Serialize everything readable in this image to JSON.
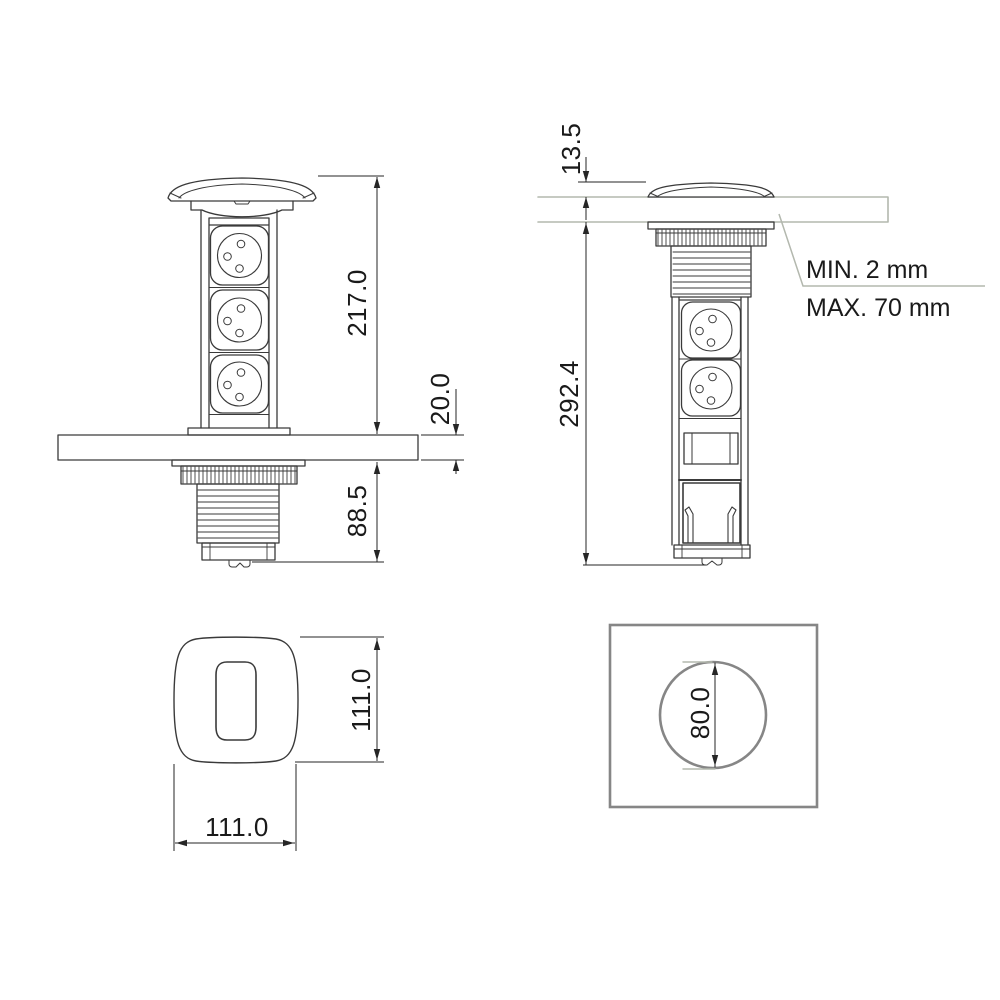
{
  "colors": {
    "background": "#ffffff",
    "line": "#3a3a3a",
    "dimension": "#262626",
    "light_line": "#b3b8ae",
    "cutout_gray": "#868686"
  },
  "front_view": {
    "pop_up_height": "217.0",
    "counter_thickness": "20.0",
    "under_counter_depth": "88.5"
  },
  "side_view": {
    "lid_height": "13.5",
    "overall_height": "292.4",
    "note_min": "MIN. 2 mm",
    "note_max": "MAX. 70 mm"
  },
  "top_view": {
    "height": "111.0",
    "width": "111.0"
  },
  "cutout_view": {
    "hole_diameter": "80.0"
  }
}
